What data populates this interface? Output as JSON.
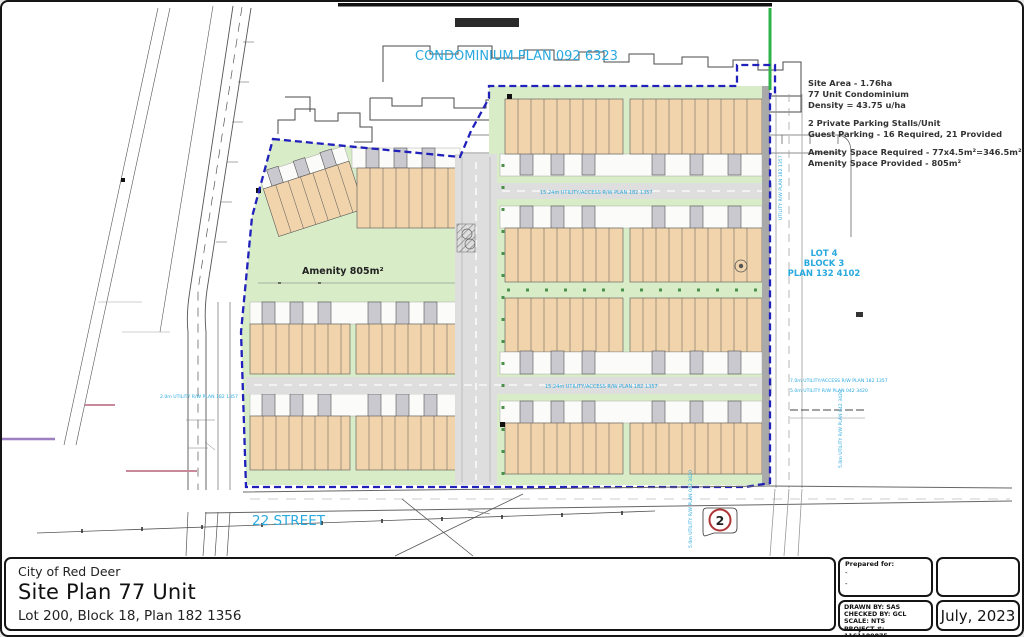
{
  "colors": {
    "cyan": "#2aa9de",
    "boundary_blue": "#2020bb",
    "building_tan": "#f1d4ab",
    "yard_green": "#d9ecc8",
    "road_gray": "#dedede",
    "stall_gray": "#c9c9cf",
    "marker_red": "#b03535",
    "bright_green": "#2db34a",
    "pink_mark": "#c8899a",
    "purple_mark": "#9b7fc0"
  },
  "plan": {
    "condo_label": "CONDOMINIUM PLAN 092 6323",
    "street_label": "22 STREET",
    "amenity_label": "Amenity 805m²",
    "marker": "2",
    "lot": {
      "l1": "LOT 4",
      "l2": "BLOCK 3",
      "l3": "PLAN 132 4102"
    },
    "road_label_1": "15.24m UTILITY/ACCESS R/W PLAN 182 1357",
    "road_label_2": "15.24m UTILITY/ACCESS R/W PLAN 182 1357",
    "row_label_1": "7.0m UTILITY/ACCESS R/W PLAN 182 1357",
    "row_label_2": "5.0m UTILITY R/W PLAN 042 3420",
    "row_label_left": "2.0m UTILITY R/W PLAN 182 1357",
    "vert_label_1": "UTILITY R/W PLAN 182 1357",
    "vert_label_2": "5.0m UTILITY R/W PLAN 042 3420",
    "notes": [
      "Site Area - 1.76ha",
      "77 Unit Condominium",
      "Density = 43.75 u/ha",
      "2 Private Parking Stalls/Unit",
      "Guest Parking - 16 Required, 21 Provided",
      "Amenity Space Required - 77x4.5m²=346.5m²",
      "Amenity Space Provided - 805m²"
    ]
  },
  "title_block": {
    "municipality": "City of Red Deer",
    "title": "Site Plan 77 Unit",
    "subtitle": "Lot 200, Block 18, Plan 182 1356",
    "prepared_for_label": "Prepared for:",
    "prepared_line1": "-",
    "prepared_line2": "-",
    "drawn_by": "DRAWN BY: SAS",
    "checked_by": "CHECKED BY: GCL",
    "scale": "SCALE: NTS",
    "project": "PROJECT #: 1161109875",
    "date": "July, 2023"
  }
}
